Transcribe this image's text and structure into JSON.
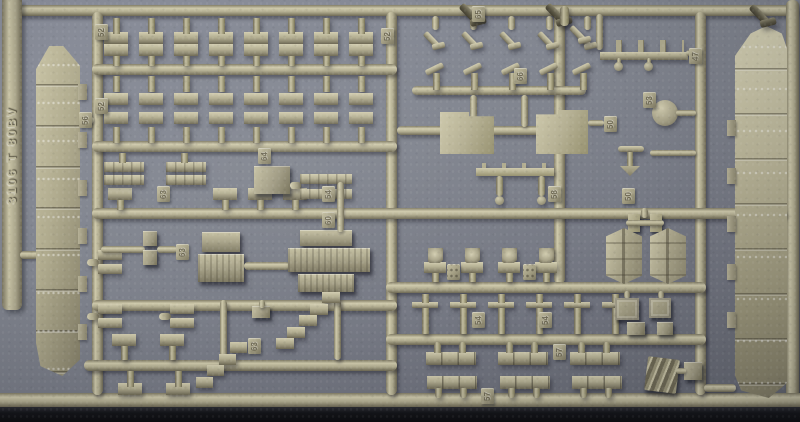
{
  "photo": {
    "subject": "Olive-drab injection-molded plastic model kit sprue (ship parts tree) photographed on a gray backing",
    "plastic_color_hex": "#aaa58a",
    "background_color_hex": "#7d8290",
    "shadow_strip_color_hex": "#121317"
  },
  "sprue": {
    "embossed_code": "3106 T 80BV"
  },
  "part_tags": [
    {
      "label": "52"
    },
    {
      "label": "52"
    },
    {
      "label": "56"
    },
    {
      "label": "52"
    },
    {
      "label": "65"
    },
    {
      "label": "66"
    },
    {
      "label": "64"
    },
    {
      "label": "63"
    },
    {
      "label": "54"
    },
    {
      "label": "60"
    },
    {
      "label": "63"
    },
    {
      "label": "50"
    },
    {
      "label": "53"
    },
    {
      "label": "47"
    },
    {
      "label": "58"
    },
    {
      "label": "50"
    },
    {
      "label": "54"
    },
    {
      "label": "54"
    },
    {
      "label": "57"
    },
    {
      "label": "57"
    },
    {
      "label": "63"
    }
  ]
}
